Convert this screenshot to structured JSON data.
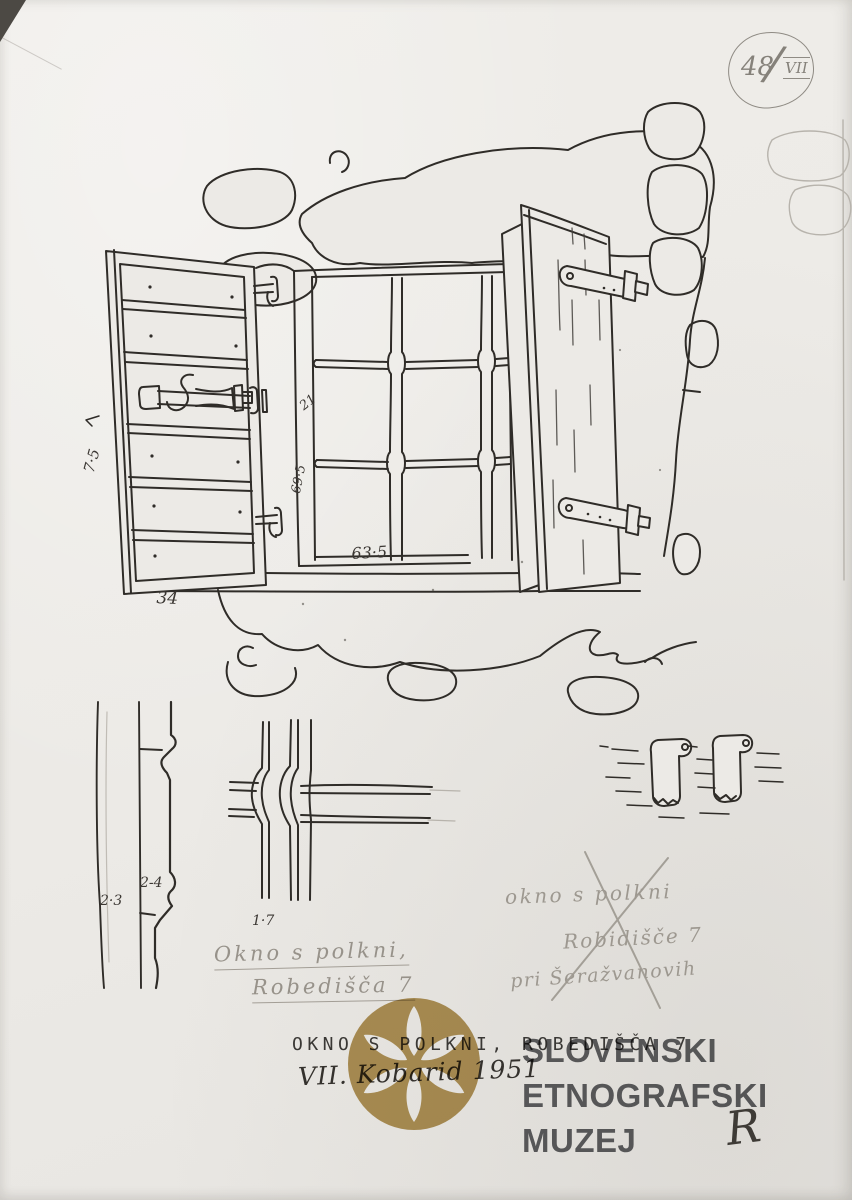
{
  "paper": {
    "background": "#ECEAE6",
    "ink": "#2F2C28",
    "pencil": "#908C85"
  },
  "stamp": {
    "number": "48",
    "slash": "/",
    "series": "VII"
  },
  "measurements": {
    "shutter_board": "7·5",
    "shutter_width": "34",
    "frame_jamb": "21",
    "window_height": "69·5",
    "window_width": "63·5",
    "profile_a": "2·3",
    "profile_b": "2-4",
    "bar_detail": "1·7"
  },
  "notes": {
    "title_line1": "Okno s polkni,",
    "title_line2": "Robedišča 7",
    "crossed_line1": "okno s polkni",
    "crossed_line2": "Robidišče 7",
    "crossed_line3": "pri Šeražvanovih"
  },
  "caption": {
    "typed_title": "OKNO S POLKNI, ROBEDIŠČA 7",
    "handwritten_date": "VII. Kobarid 1951",
    "signature": "R"
  },
  "watermark": {
    "line1": "SLOVENSKI",
    "line2": "ETNOGRAFSKI",
    "line3": "MUZEJ",
    "gold": "#B39352",
    "text_color": "#55565A"
  }
}
